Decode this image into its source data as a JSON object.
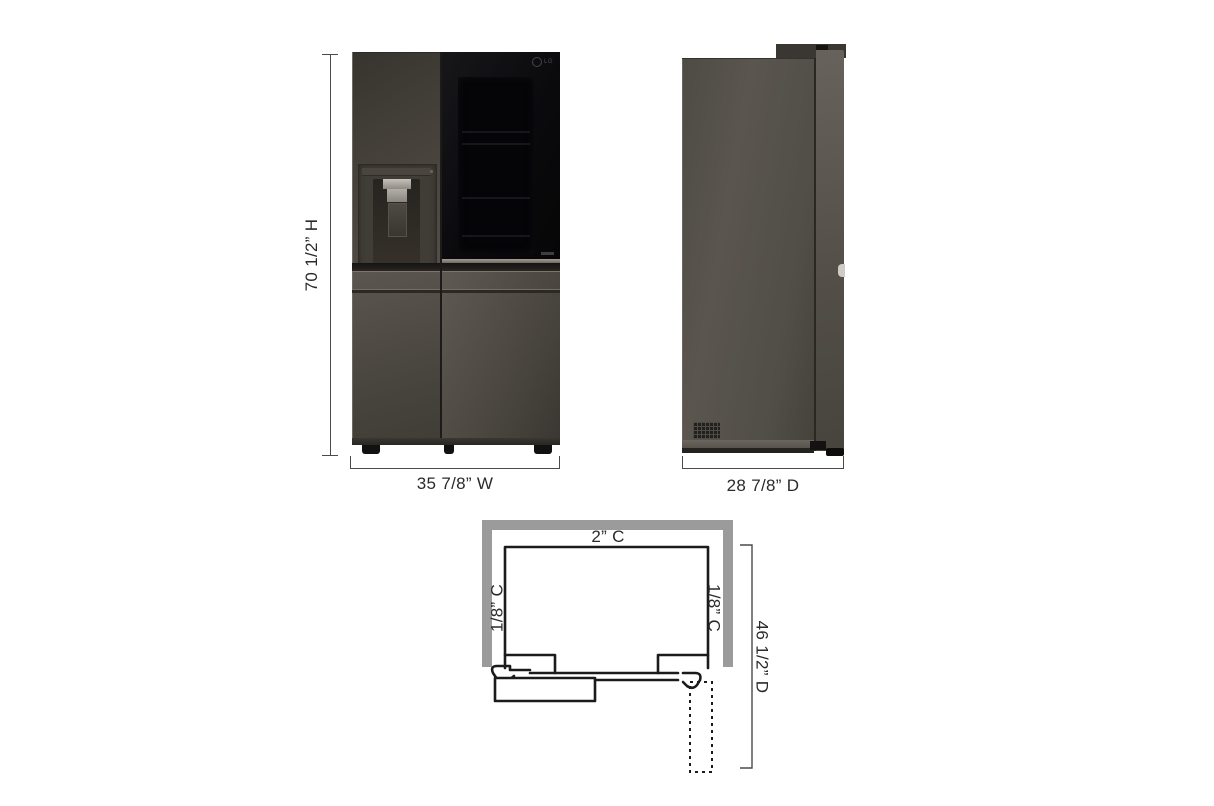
{
  "front_view": {
    "height_label": "70 1/2” H",
    "width_label": "35 7/8” W",
    "brand_logo": "LG"
  },
  "side_view": {
    "depth_label": "28 7/8” D"
  },
  "top_view": {
    "rear_clearance_label": "2” C",
    "left_clearance_label": "1/8” C",
    "right_clearance_label": "1/8” C",
    "open_door_depth_label": "46 1/2” D"
  },
  "colors": {
    "background": "#ffffff",
    "wall_outline": "#9b9b9b",
    "diagram_line": "#1b1b1b",
    "dimension_line": "#4a4a4a",
    "label_text": "#2b2b2b",
    "appliance_body": "#524e48",
    "appliance_glass": "#0b0b0d"
  }
}
